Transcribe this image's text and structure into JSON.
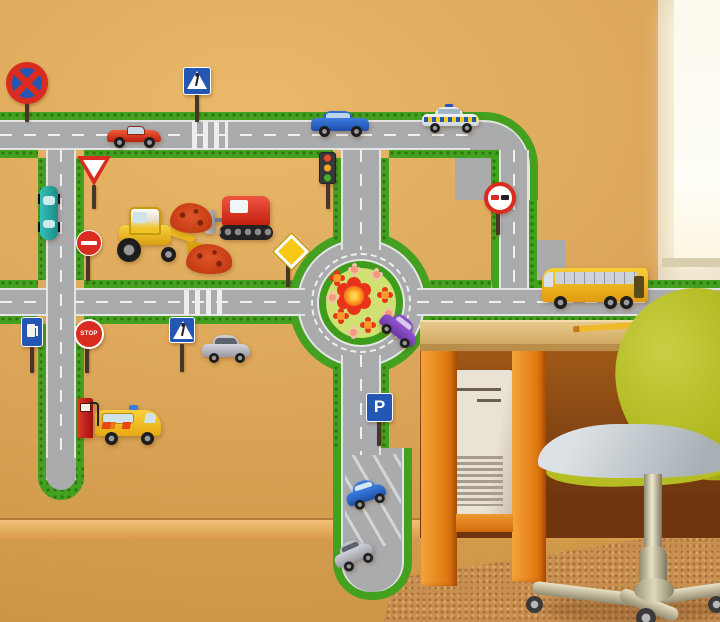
{
  "scene": {
    "setting": "children's room wall decorated with a road-play sticker set, with a desk, computer tower and office chair in front"
  },
  "colors": {
    "wall": "#dca75a",
    "road": "#a9abad",
    "green": "#44a01f",
    "island": "#cfe170",
    "carpet": "#c79050",
    "chair": "#aab215",
    "sign-blue": "#2456b4",
    "sign-red": "#d92b1f",
    "bus-yellow": "#f5b623"
  },
  "signs": {
    "parking_label": "P",
    "stop_label": "STOP"
  },
  "objects": [
    "no-stopping-sign",
    "pedestrian-crossing-sign",
    "yield-sign",
    "traffic-light",
    "no-entry-sign",
    "priority-road-sign",
    "no-overtaking-sign",
    "stop-sign",
    "fuel-station-sign",
    "parking-sign",
    "red-sports-car",
    "blue-sedan",
    "police-car",
    "teal-car",
    "yellow-excavator",
    "red-bulldozer",
    "dirt-piles",
    "silver-car",
    "purple-car",
    "yellow-van",
    "fuel-pump",
    "yellow-bus",
    "blue-city-car",
    "gray-city-car",
    "flower-roundabout",
    "parking-dead-end",
    "zebra-crossings",
    "orange-desk",
    "computer-tower",
    "pencil",
    "green-office-chair",
    "window",
    "rug",
    "wooden-floor"
  ]
}
